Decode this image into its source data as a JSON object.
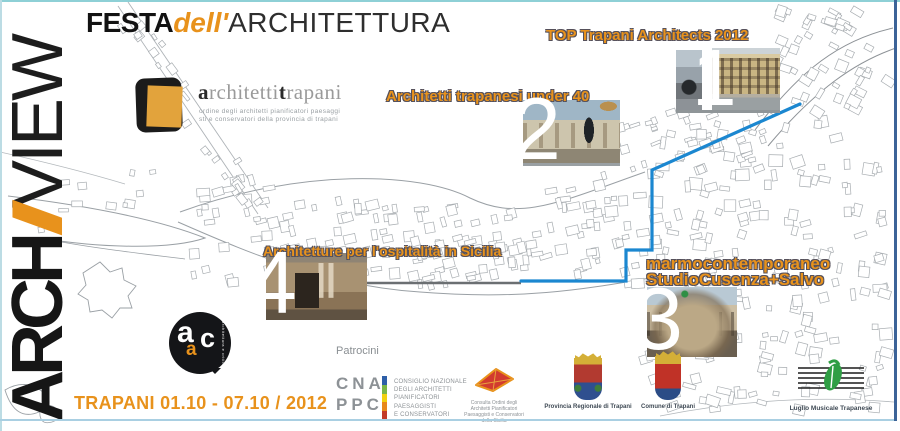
{
  "colors": {
    "orange": "#E8921C",
    "label_outline": "#55505A",
    "route_blue": "#1B87D0",
    "map_gray": "#A6ABAF"
  },
  "header": {
    "archiview": {
      "part_bold": "ARCH",
      "part_slash": "I",
      "part_light": "VIEW"
    },
    "title": {
      "festa": "FESTA",
      "dell": "dell'",
      "architettura": "ARCHITETTURA"
    },
    "ordine_logo": {
      "word_a": "a",
      "word_rchitetti": "rchitetti",
      "word_t": "t",
      "word_rapani": "rapani",
      "subtitle_line1": "ordine degli architetti pianificatori paesaggi",
      "subtitle_line2": "sti e conservatori della provincia di trapani"
    }
  },
  "events": [
    {
      "number": "1",
      "label": "TOP Trapani Architects 2012"
    },
    {
      "number": "2",
      "label": "Architetti trapanesi under 40"
    },
    {
      "number": "3",
      "label_line1": "marmocontemporaneo",
      "label_line2": "StudioCusenza+Salvo"
    },
    {
      "number": "4",
      "label": "Architetture per l'ospitalità in Sicilia"
    }
  ],
  "aiac": {
    "letter_a_top": "a",
    "letter_a_small": "a",
    "letter_c": "c",
    "side_text": "architettura e critica"
  },
  "footer": {
    "dates": "TRAPANI 01.10 - 07.10 / 2012",
    "patrocini_label": "Patrocini",
    "cna": {
      "line1": "CNA",
      "line2": "PPC",
      "bar_colors": [
        "#2E5FA8",
        "#7AB648",
        "#F2D00E",
        "#E8881A",
        "#C23A28"
      ],
      "caption_lines": [
        "CONSIGLIO NAZIONALE",
        "DEGLI ARCHITETTI",
        "PIANIFICATORI",
        "PAESAGGISTI",
        "E CONSERVATORI"
      ]
    },
    "consulta": {
      "caption_lines": [
        "Consulta Ordini degli",
        "Architetti Pianificatori",
        "Paesaggisti e Conservatori",
        "della Sicilia"
      ]
    },
    "provincia": {
      "caption": "Provincia Regionale di Trapani"
    },
    "comune": {
      "caption": "Comune di Trapani"
    },
    "luglio": {
      "caption": "Luglio Musicale Trapanese"
    }
  }
}
